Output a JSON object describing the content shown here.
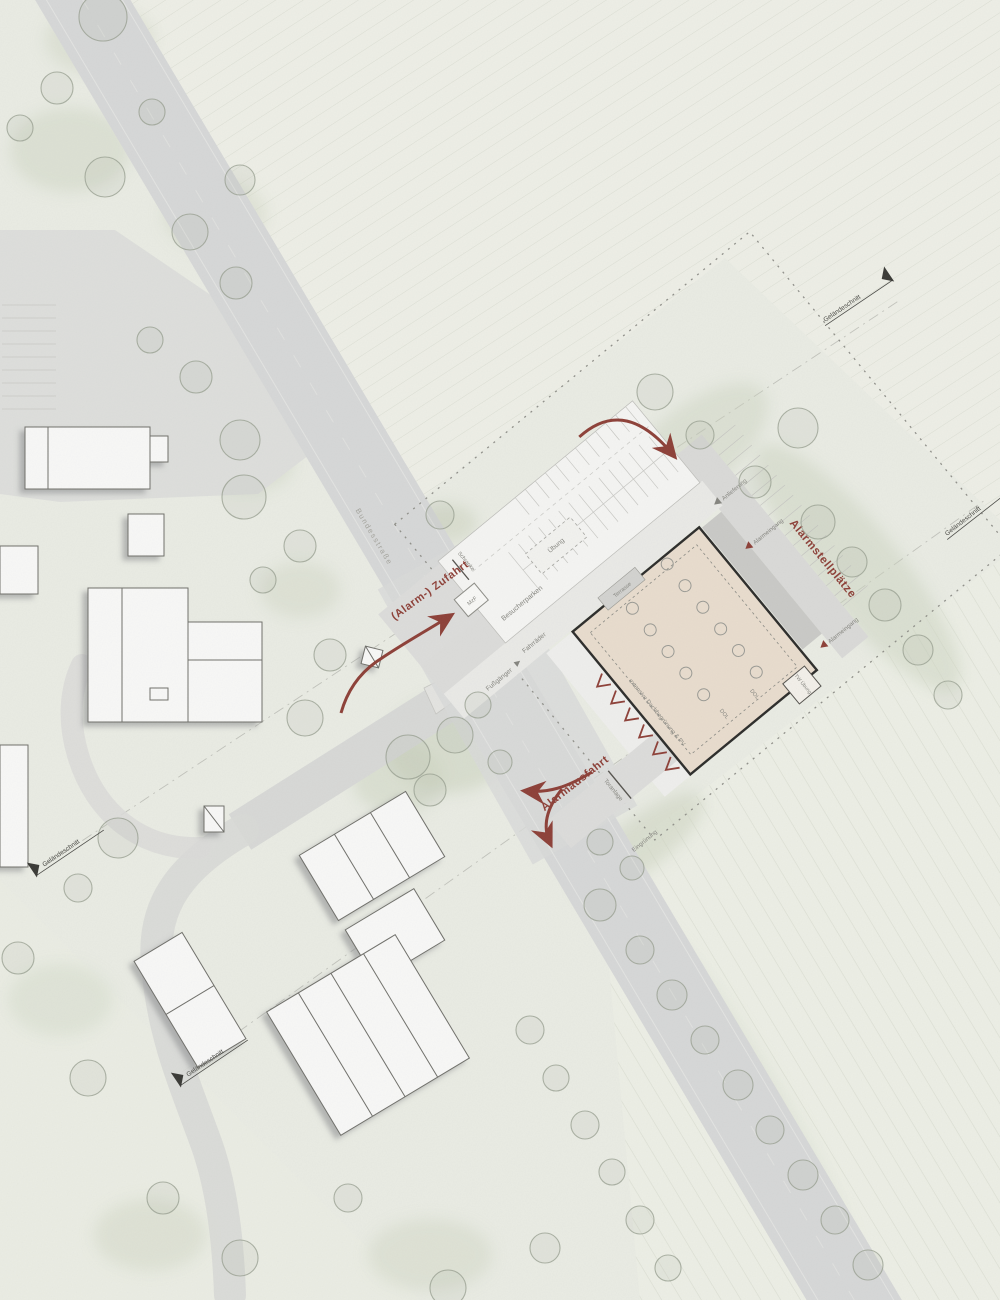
{
  "plan": {
    "type": "architectural site plan (Lageplan, fire station)",
    "language": "German"
  },
  "labels": {
    "red": {
      "zufahrt": "(Alarm-) Zufahrt",
      "ausfahrt": "Alarmausfahrt",
      "stellplaetze": "Alarmstellplätze"
    },
    "site": {
      "besucherparken": "Besucherparken",
      "uebung": "Übung",
      "schranke": "Schranke",
      "mzf": "MzF",
      "fussgaenger": "Fußgänger",
      "fahrraeder": "Fahrräder",
      "terrasse": "Terrasse",
      "dachbegruenung": "extensive Dachbegrünung & PV",
      "dol": "DOL",
      "tw_uebung": "TW Übung",
      "anlieferung": "Anlieferung",
      "alarmeingang": "Alarmeingang",
      "toranlage": "Toranlage",
      "eingruenung": "Eingrünung"
    },
    "street": {
      "name": "Bundesstraße"
    },
    "section": {
      "gelaendeschnitt": "Geländeschnitt"
    }
  },
  "colors": {
    "background": "#e9ebe3",
    "road_gray": "#d7d8d7",
    "paving_light": "#e6e6e3",
    "building_white": "#f7f7f6",
    "building_outline": "#6f6f6a",
    "new_building_roof_beige": "#e8dccd",
    "new_building_outline": "#2d2d2b",
    "hall_gray": "#c9c9c6",
    "accent_red": "#8d4038",
    "tree_gray_green": "#9aa093",
    "soft_green": "#ccd3bf",
    "boundary_dash_gray": "#90908a",
    "label_gray": "#85857f"
  },
  "symbols": {
    "skylight_circles_rows": 2,
    "gate_chevrons_red": 6,
    "section_markers": 4
  }
}
